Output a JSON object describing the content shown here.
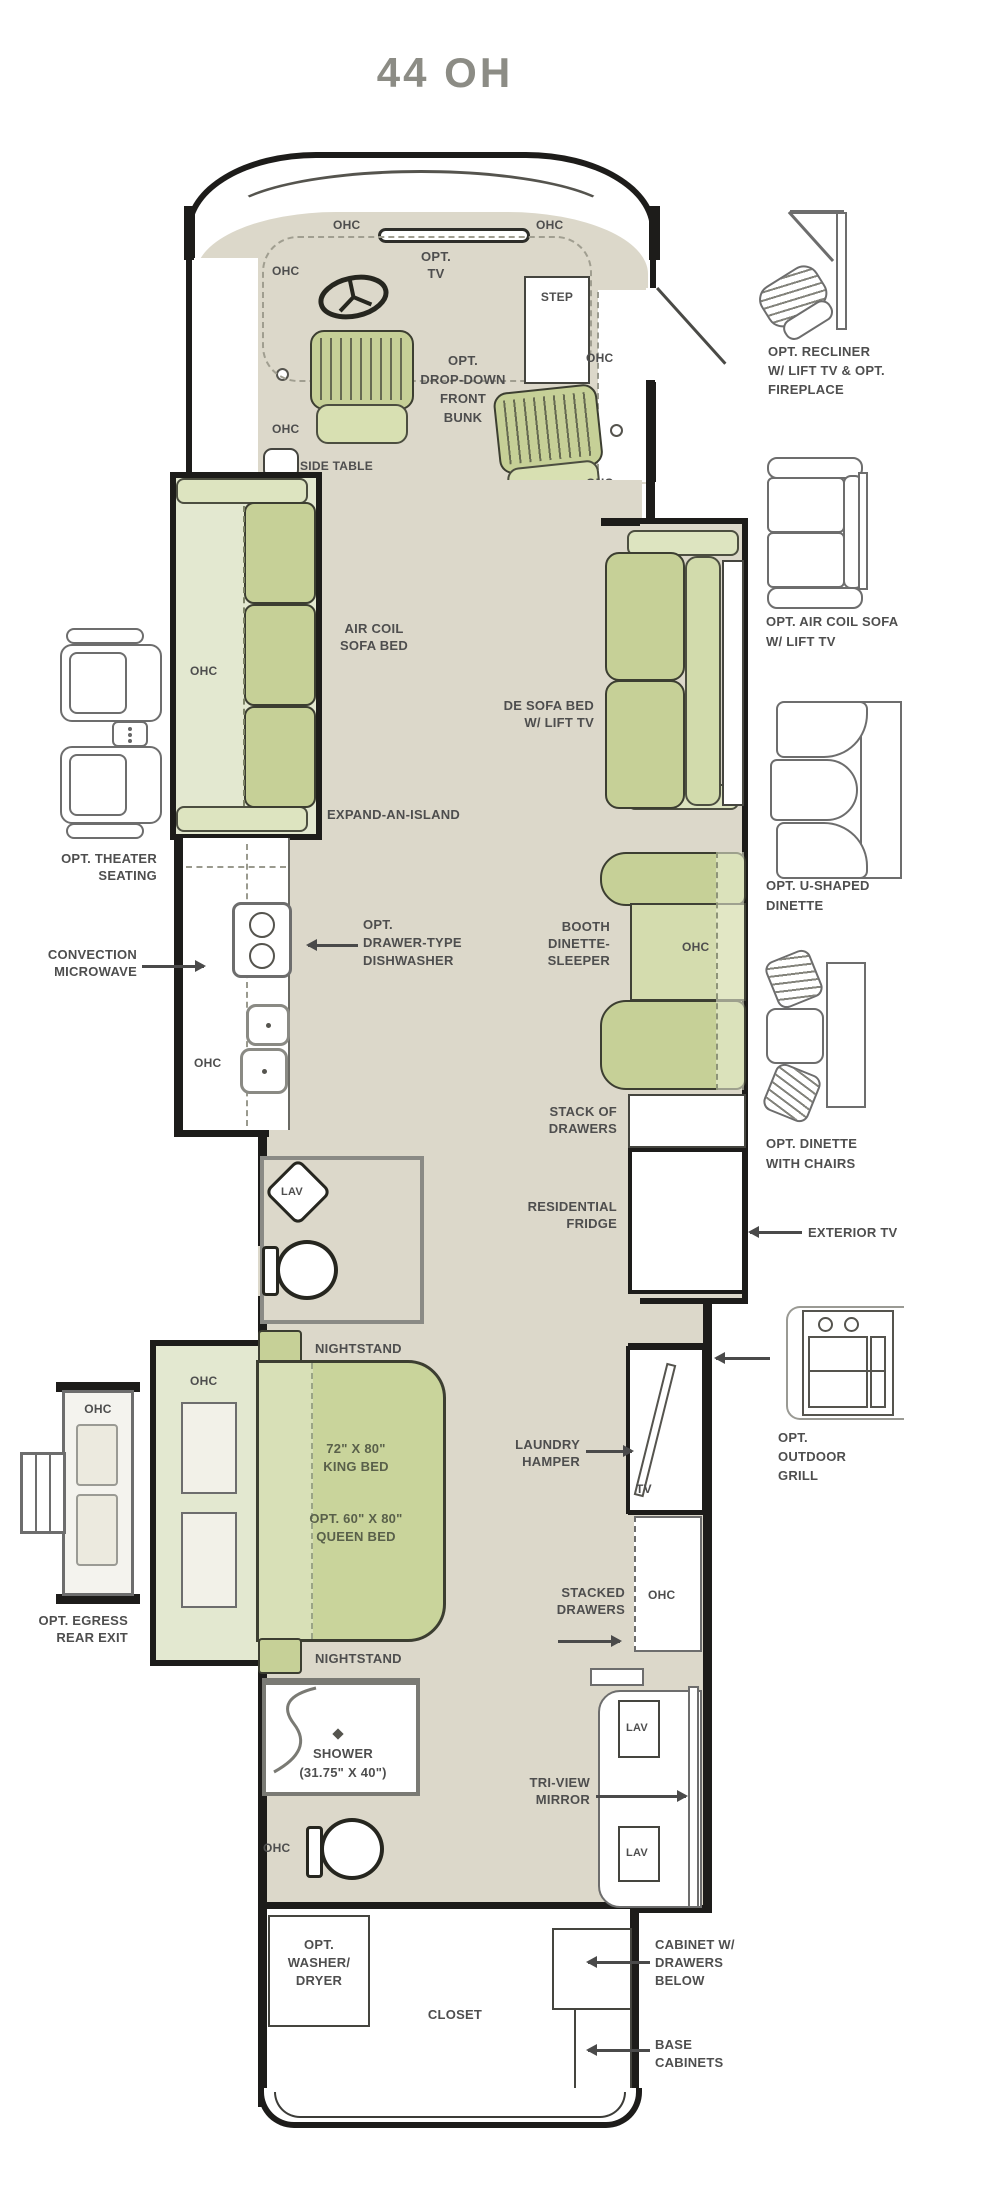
{
  "title": "44 OH",
  "common": {
    "ohc": "OHC",
    "lav": "LAV",
    "tv": "TV",
    "step": "STEP",
    "side_table": "SIDE TABLE",
    "nightstand": "NIGHTSTAND",
    "closet": "CLOSET"
  },
  "front": {
    "opt_tv": [
      "OPT.",
      "TV"
    ],
    "bunk": [
      "OPT.",
      "DROP-DOWN",
      "FRONT",
      "BUNK"
    ]
  },
  "living": {
    "air_coil": [
      "AIR COIL",
      "SOFA BED"
    ],
    "de_sofa": [
      "DE SOFA BED",
      "W/ LIFT TV"
    ],
    "island": "EXPAND-AN-ISLAND"
  },
  "kitchen": {
    "microwave": [
      "CONVECTION",
      "MICROWAVE"
    ],
    "dishwasher": [
      "OPT.",
      "DRAWER-TYPE",
      "DISHWASHER"
    ],
    "booth": [
      "BOOTH",
      "DINETTE-",
      "SLEEPER"
    ],
    "stack": [
      "STACK OF",
      "DRAWERS"
    ],
    "fridge": [
      "RESIDENTIAL",
      "FRIDGE"
    ]
  },
  "bedroom": {
    "king": [
      "72\" X 80\"",
      "KING BED"
    ],
    "queen": [
      "OPT. 60\" X 80\"",
      "QUEEN BED"
    ],
    "laundry": [
      "LAUNDRY",
      "HAMPER"
    ],
    "stacked": [
      "STACKED",
      "DRAWERS"
    ]
  },
  "bath": {
    "shower": [
      "SHOWER",
      "(31.75\" X 40\")"
    ],
    "triview": [
      "TRI-VIEW",
      "MIRROR"
    ]
  },
  "rear": {
    "washer": [
      "OPT.",
      "WASHER/",
      "DRYER"
    ],
    "cabinet": [
      "CABINET W/",
      "DRAWERS",
      "BELOW"
    ],
    "base": [
      "BASE",
      "CABINETS"
    ]
  },
  "left_options": {
    "theater": [
      "OPT. THEATER",
      "SEATING"
    ],
    "egress": [
      "OPT. EGRESS",
      "REAR EXIT"
    ]
  },
  "right_options": {
    "recliner": [
      "OPT. RECLINER",
      "W/ LIFT TV & OPT.",
      "FIREPLACE"
    ],
    "aircoil": [
      "OPT. AIR COIL SOFA",
      "W/ LIFT TV"
    ],
    "udinette": [
      "OPT. U-SHAPED",
      "DINETTE"
    ],
    "dinette_chairs": [
      "OPT. DINETTE",
      "WITH CHAIRS"
    ],
    "exterior_tv": "EXTERIOR TV",
    "grill": [
      "OPT.",
      "OUTDOOR",
      "GRILL"
    ]
  },
  "colors": {
    "floor": "#dcd8ca",
    "furniture_green": "#c6d097",
    "slide_green": "#e3e8d0",
    "wall": "#1d1c1a",
    "label": "#4e4e4e",
    "title": "#8c8c85"
  }
}
